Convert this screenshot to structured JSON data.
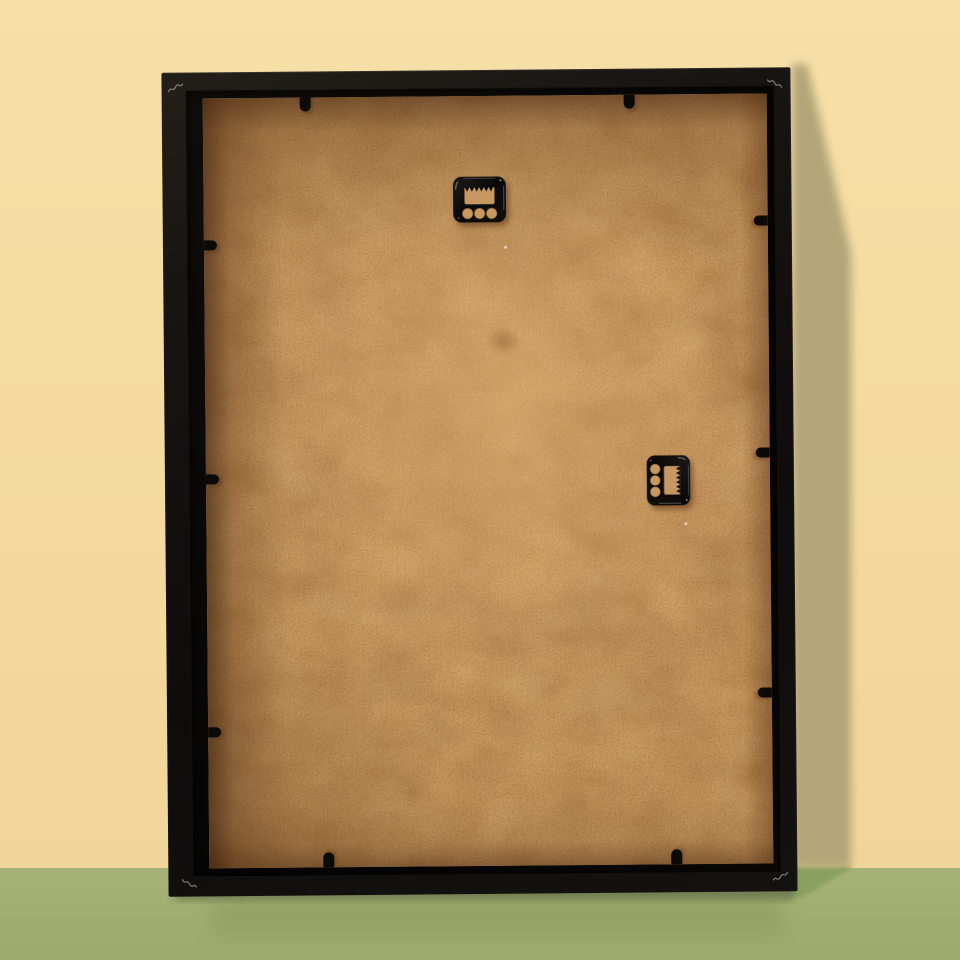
{
  "meta": {
    "description": "Back view of a black wooden picture frame with a kraft-brown MDF backing board, leaning against a pale yellow wall and standing on a sage green floor; two black sawtooth hangers and ten black flexi clips are visible, no text anywhere in the image."
  },
  "colors": {
    "wall": "#f3d99e",
    "wall_light": "#f6dfa8",
    "wall_shadow": "#b4a578",
    "floor": "#a7b276",
    "floor_shadow": "#8ba061",
    "frame_black": "#141210",
    "board": "#c59459",
    "board_light": "#d0a067",
    "board_shadow_edge": "#5e3a1e",
    "hardware_black": "#0c0b09",
    "hardware_hole": "#c79962",
    "corner_mark_gray": "#9b9b90"
  },
  "frame": {
    "hangers": [
      {
        "id": "sawtooth-hanger-top",
        "x": 248,
        "y": 76,
        "w": 56,
        "h": 55,
        "rotation": 0
      },
      {
        "id": "sawtooth-hanger-side",
        "x": 436,
        "y": 358,
        "w": 53,
        "h": 56,
        "rotation": 90
      }
    ],
    "clips": [
      {
        "side": "top",
        "x": 97
      },
      {
        "side": "top",
        "x": 421
      },
      {
        "side": "bottom",
        "x": 114
      },
      {
        "side": "bottom",
        "x": 462
      },
      {
        "side": "left",
        "y": 142
      },
      {
        "side": "left",
        "y": 376
      },
      {
        "side": "left",
        "y": 629
      },
      {
        "side": "right",
        "y": 122
      },
      {
        "side": "right",
        "y": 354
      },
      {
        "side": "right",
        "y": 594
      }
    ],
    "corner_marks": [
      {
        "corner": "top-left",
        "x": 6,
        "y": 9
      },
      {
        "corner": "top-right",
        "x": 605,
        "y": 10
      },
      {
        "corner": "bottom-left",
        "x": 13,
        "y": 804
      },
      {
        "corner": "bottom-right",
        "x": 604,
        "y": 802
      }
    ],
    "hanger_count": 2,
    "clip_count": 10
  }
}
